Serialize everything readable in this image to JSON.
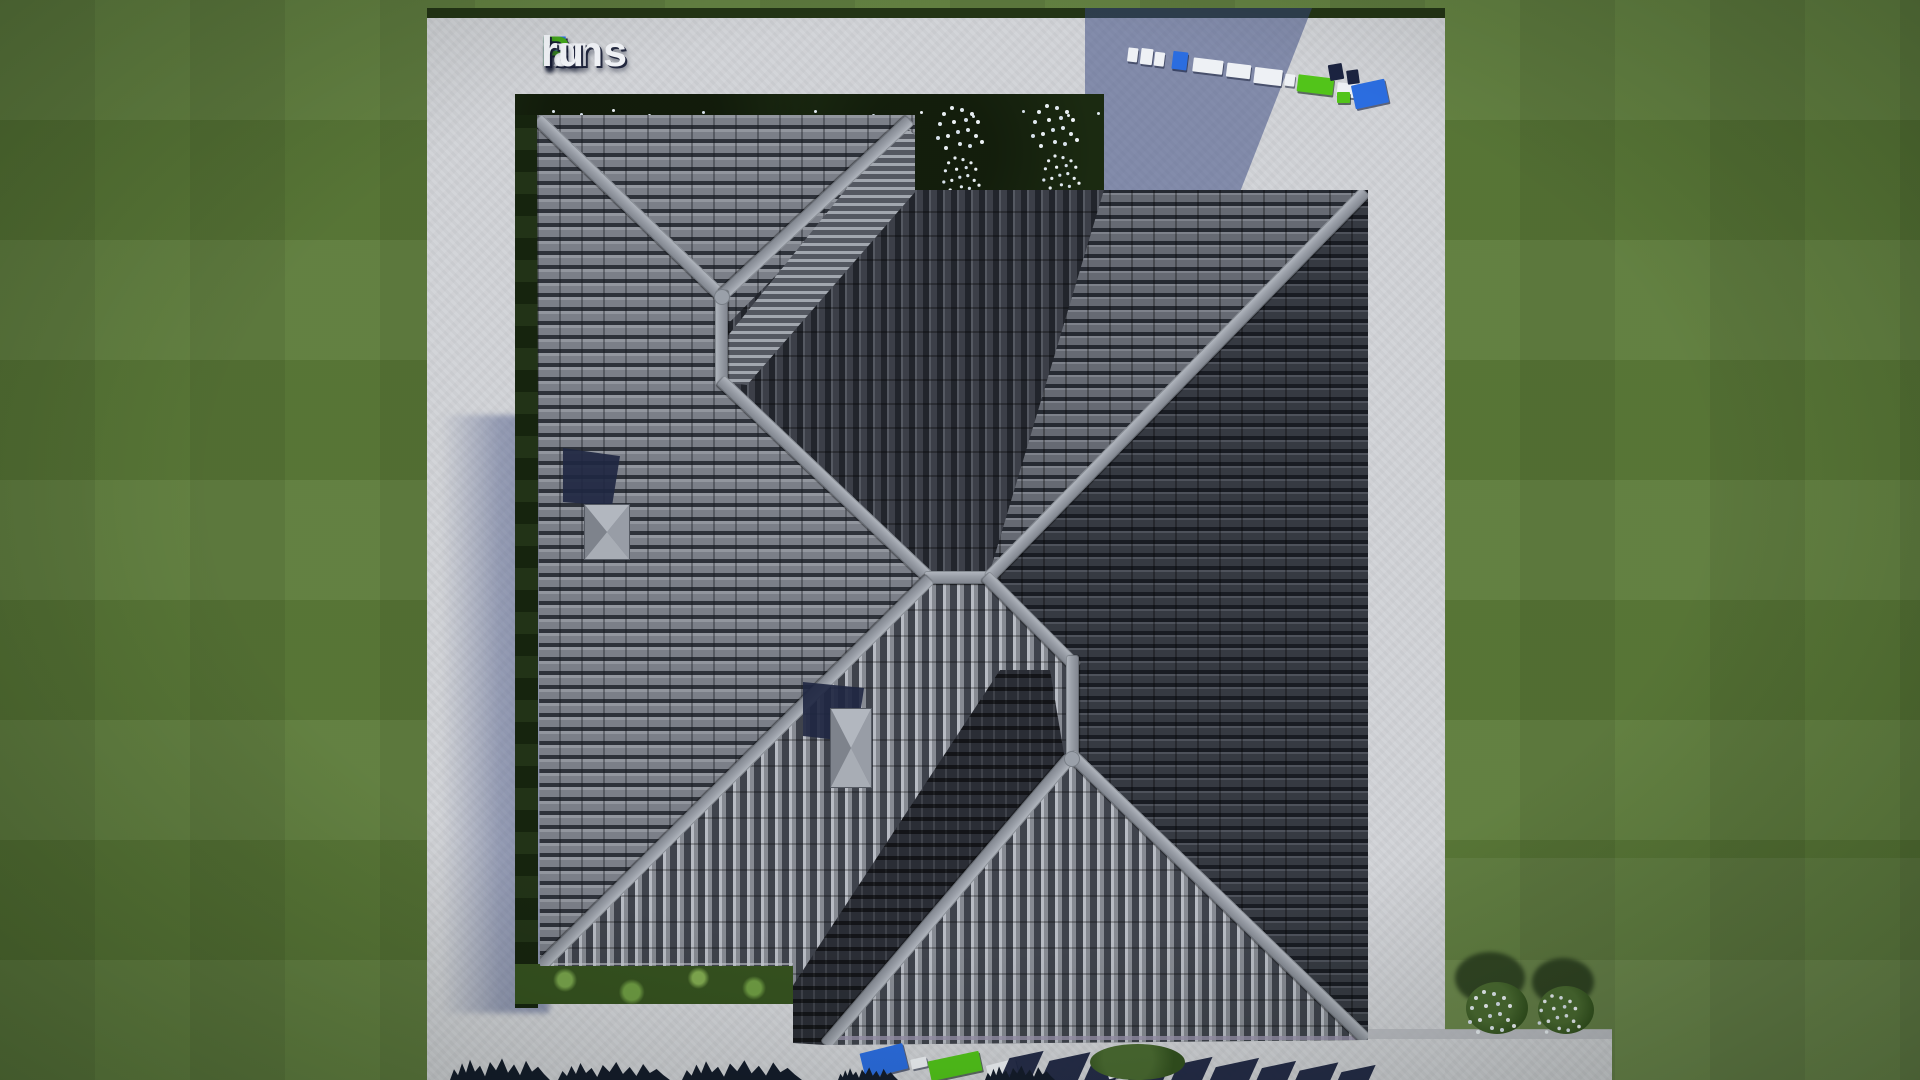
{
  "brand": {
    "watermark_text": "FixPlans.ru",
    "watermark_parts": [
      {
        "text": "F",
        "color": "#2b6de0"
      },
      {
        "text": "ix",
        "color": "#f2f4f8"
      },
      {
        "text": "P",
        "color": "#43a71a"
      },
      {
        "text": "lans",
        "color": "#f2f4f8"
      },
      {
        "text": ".",
        "color": "#43a71a"
      },
      {
        "text": "ru",
        "color": "#f2f4f8"
      }
    ]
  },
  "palette": {
    "grass": "#5c7b39",
    "hedge_dark": "#1b2a11",
    "concrete": "#d2d4d8",
    "cast_shadow_blue": "rgba(57,73,128,0.52)",
    "roof_tile_medium": "#7b7f88",
    "roof_tile_dark": "#363a42",
    "roof_tile_light_ribs": "#a9adb5",
    "ridge_gray": "#9aa0a9",
    "chimney_gray": "#a4a9b2",
    "shadow_navy": "#1f2742",
    "logo_blue": "#2b6de0",
    "logo_green": "#52c41a",
    "gutter_lavender": "#9a93ad"
  },
  "scene": {
    "view": "top-down aerial render of a hip-roof house plot",
    "elements": [
      "lawn",
      "concrete-plot",
      "top-hedge-with-white-flowers",
      "left-hedge-strip",
      "bottom-garden-strip",
      "gray-tiled-hip-roof",
      "roof-chimney-1",
      "roof-chimney-2",
      "3d-ground-logo-top-right",
      "3d-ground-logo-bottom",
      "tree-row-bottom",
      "white-flower-bushes-bottom-right",
      "cast-shadows"
    ]
  }
}
